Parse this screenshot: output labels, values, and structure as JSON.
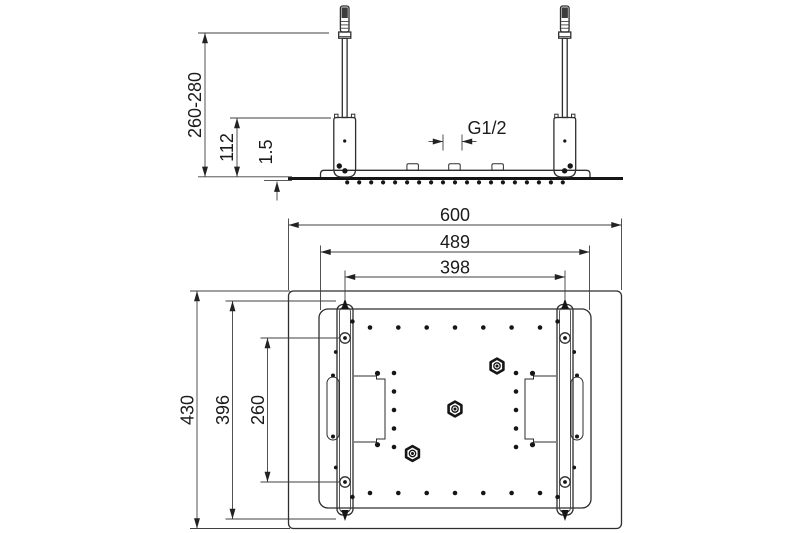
{
  "drawing": {
    "type": "technical-dimension-drawing",
    "views": [
      "side-elevation",
      "bottom-plan"
    ],
    "colors": {
      "background": "#ffffff",
      "line": "#2e2e2e",
      "dimension_line": "#3f3f3f",
      "text": "#1b1b1b"
    }
  },
  "side_view": {
    "labels": {
      "mounting_height": "260-280",
      "bracket_height": "112",
      "panel_thickness": "1.5",
      "thread_size": "G1/2"
    }
  },
  "plan_view": {
    "labels": {
      "overall_width": "600",
      "panel_width": "489",
      "rail_spacing": "398",
      "overall_depth": "430",
      "rail_length": "396",
      "hole_spacing": "260"
    }
  }
}
